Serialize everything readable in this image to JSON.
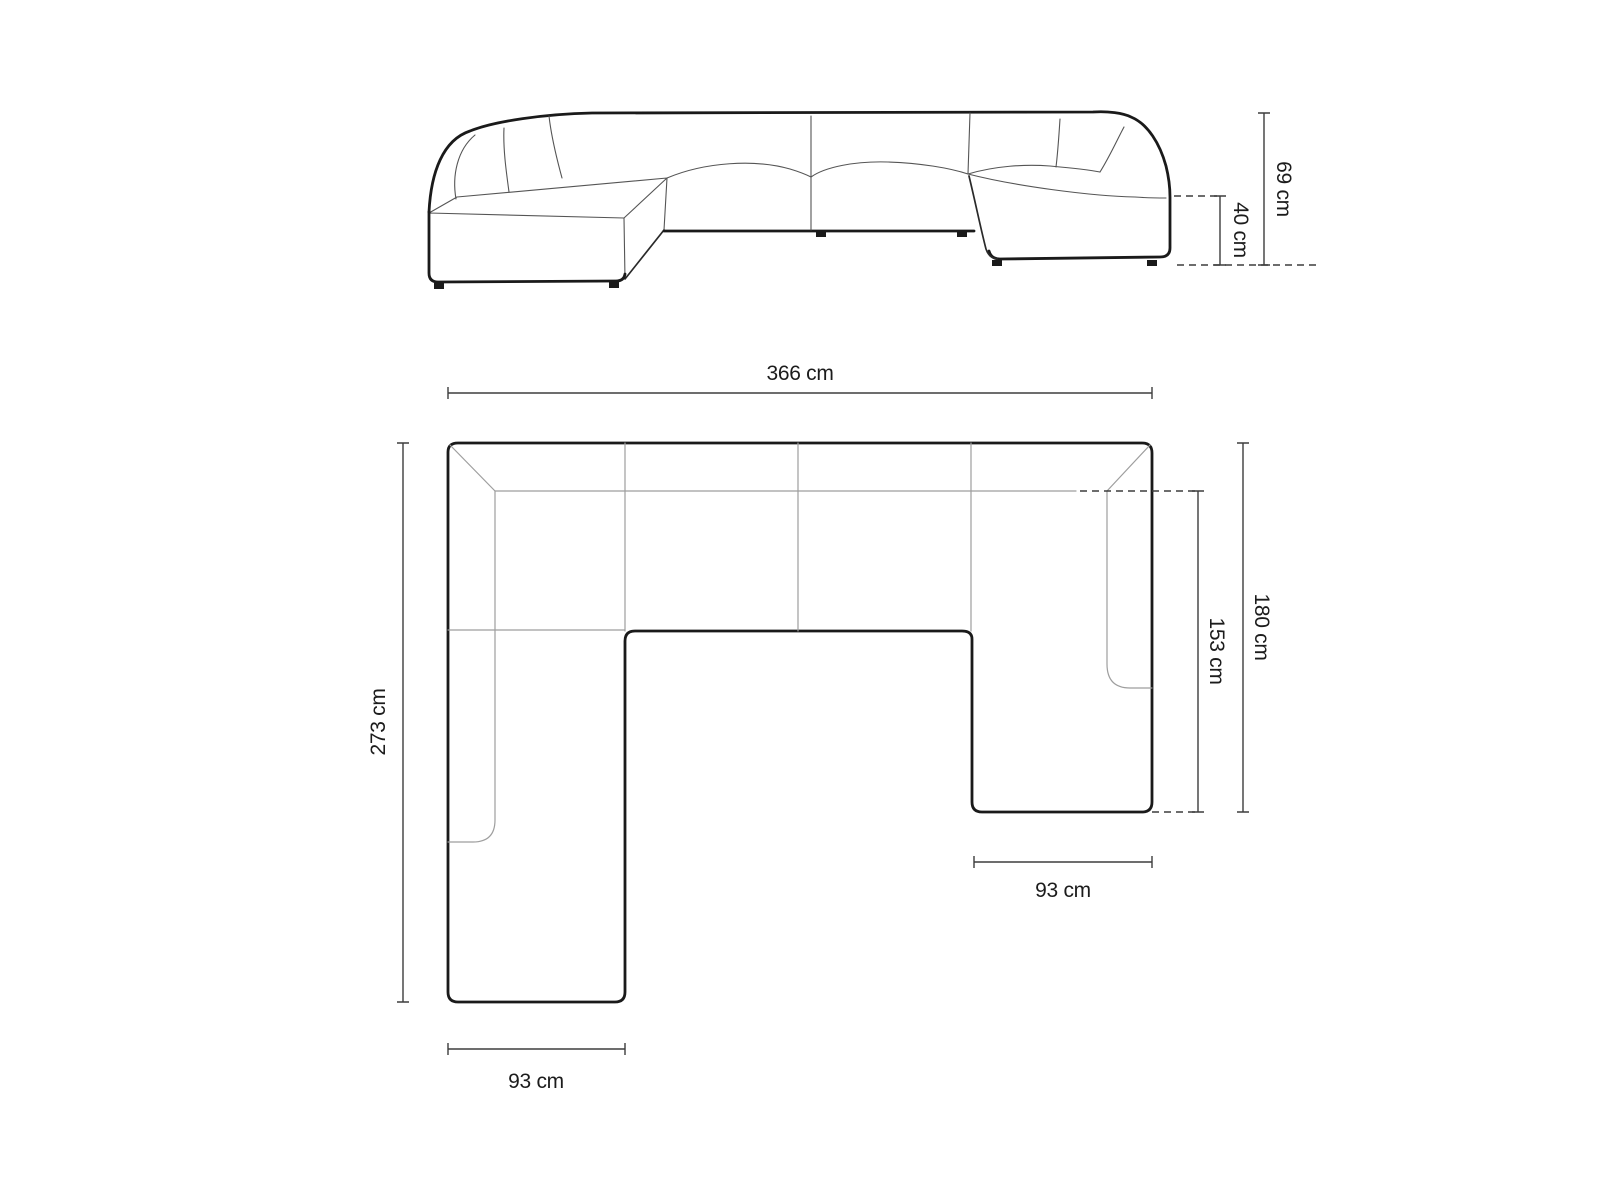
{
  "diagram": {
    "subject": "panoramic-u-shape-sofa-dimension-drawing",
    "unit": "cm",
    "front_view": {
      "name": "front elevation view",
      "dims": {
        "total_height": {
          "label": "69 cm",
          "value": 69,
          "unit": "cm",
          "orientation": "vertical"
        },
        "seat_height": {
          "label": "40 cm",
          "value": 40,
          "unit": "cm",
          "orientation": "vertical"
        }
      }
    },
    "top_view": {
      "name": "top plan view",
      "dims": {
        "total_width": {
          "label": "366 cm",
          "value": 366,
          "unit": "cm",
          "orientation": "horizontal"
        },
        "left_side_depth": {
          "label": "273 cm",
          "value": 273,
          "unit": "cm",
          "orientation": "vertical"
        },
        "right_side_depth": {
          "label": "180 cm",
          "value": 180,
          "unit": "cm",
          "orientation": "vertical"
        },
        "right_inner_depth": {
          "label": "153 cm",
          "value": 153,
          "unit": "cm",
          "orientation": "vertical"
        },
        "left_leg_width": {
          "label": "93 cm",
          "value": 93,
          "unit": "cm",
          "orientation": "horizontal"
        },
        "right_leg_width": {
          "label": "93 cm",
          "value": 93,
          "unit": "cm",
          "orientation": "horizontal"
        }
      }
    }
  }
}
